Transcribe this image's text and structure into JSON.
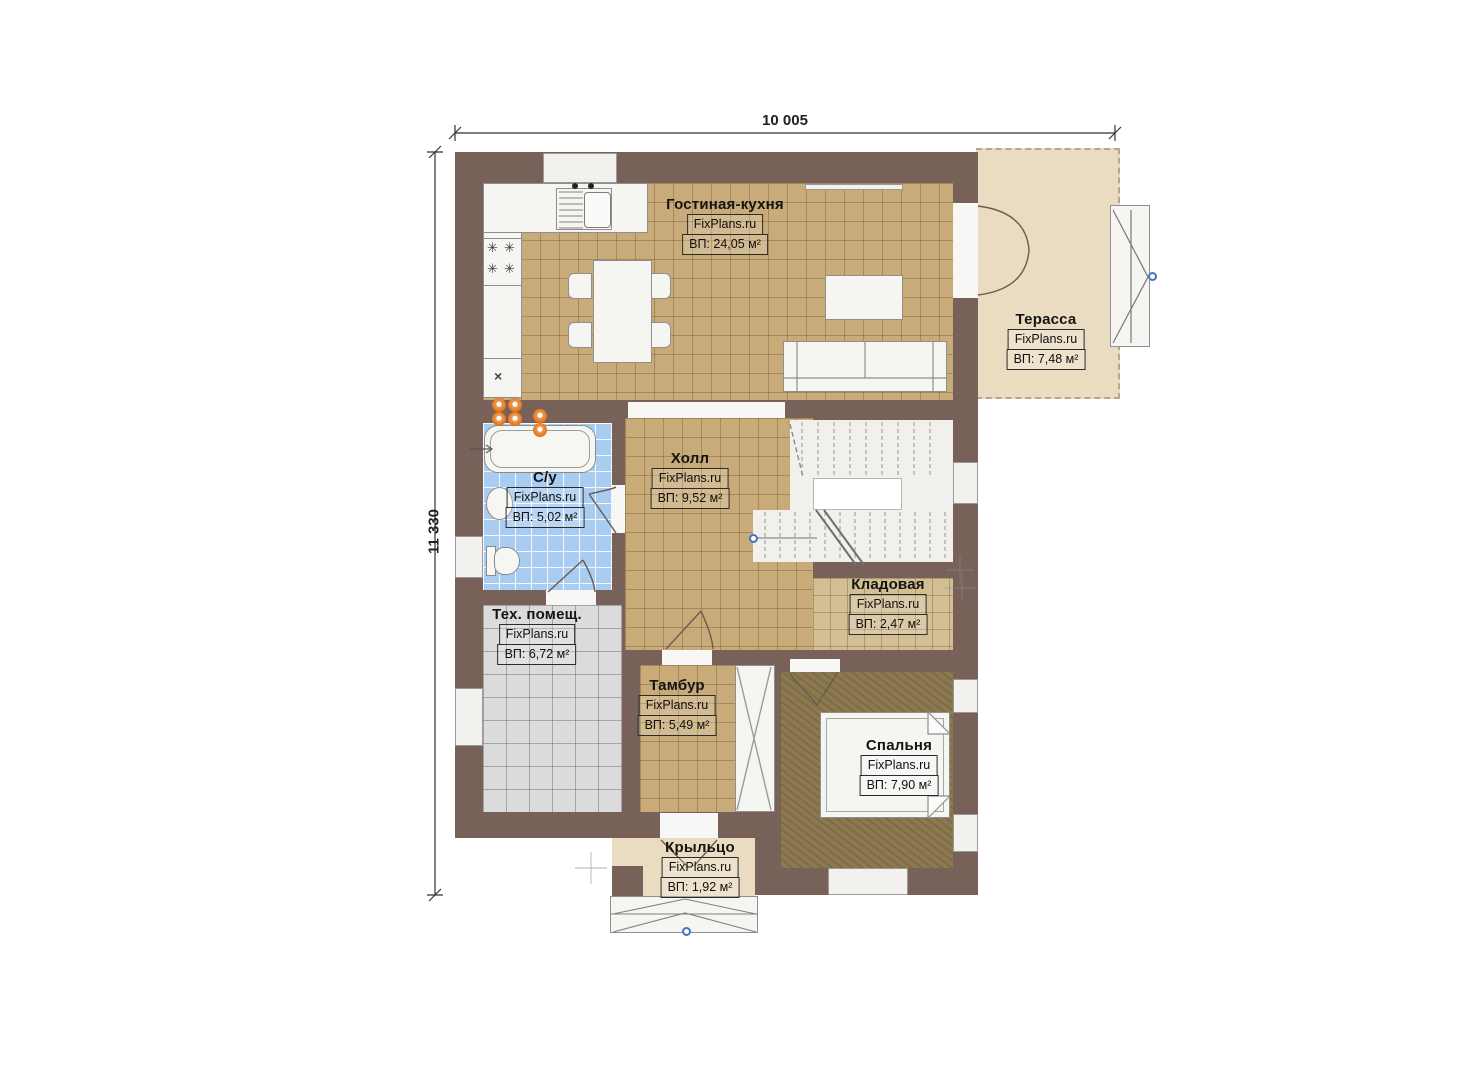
{
  "plan": {
    "brand": "FixPlans.ru",
    "dimensions": {
      "top": "10 005",
      "left": "11 330"
    },
    "rooms": [
      {
        "id": "living",
        "name": "Гостиная-кухня",
        "area": "ВП: 24,05 м²"
      },
      {
        "id": "terrace",
        "name": "Терасса",
        "area": "ВП: 7,48 м²"
      },
      {
        "id": "bathroom",
        "name": "С/у",
        "area": "ВП: 5,02 м²"
      },
      {
        "id": "hall",
        "name": "Холл",
        "area": "ВП: 9,52 м²"
      },
      {
        "id": "storage",
        "name": "Кладовая",
        "area": "ВП: 2,47 м²"
      },
      {
        "id": "tech",
        "name": "Тех. помещ.",
        "area": "ВП: 6,72 м²"
      },
      {
        "id": "vestibule",
        "name": "Тамбур",
        "area": "ВП: 5,49 м²"
      },
      {
        "id": "bedroom",
        "name": "Спальня",
        "area": "ВП: 7,90 м²"
      },
      {
        "id": "porch",
        "name": "Крыльцо",
        "area": "ВП: 1,92 м²"
      }
    ],
    "colors": {
      "wall": "#786159",
      "floor_tan": "#c8ab79",
      "floor_storage": "#d3bf94",
      "floor_bath": "#a9cdf1",
      "floor_tech": "#dbdbdb",
      "floor_bedroom": "#8c7950",
      "floor_terrace": "#e9dcc1",
      "accent_orange": "#e0751f",
      "node_blue": "#4a72c4"
    }
  }
}
